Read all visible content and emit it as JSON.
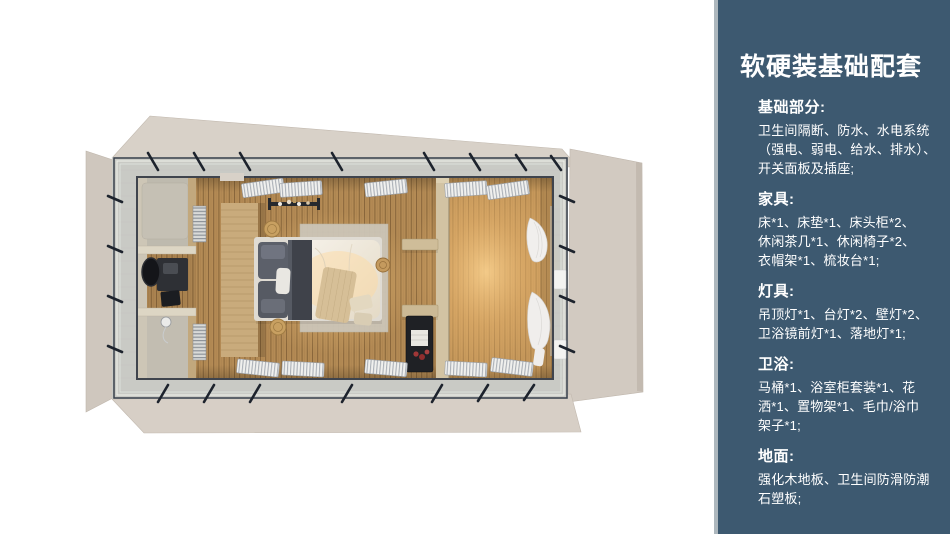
{
  "sidebar": {
    "title": "软硬装基础配套",
    "sections": [
      {
        "heading": "基础部分:",
        "lines": [
          "卫生间隔断、防水、水电系统",
          "（强电、弱电、给水、排水）、",
          "开关面板及插座;"
        ]
      },
      {
        "heading": "家具:",
        "lines": [
          "床*1、床垫*1、床头柜*2、",
          "休闲茶几*1、休闲椅子*2、",
          "衣帽架*1、梳妆台*1;"
        ]
      },
      {
        "heading": "灯具:",
        "lines": [
          "吊顶灯*1、台灯*2、壁灯*2、",
          "卫浴镜前灯*1、落地灯*1;"
        ]
      },
      {
        "heading": "卫浴:",
        "lines": [
          "马桶*1、浴室柜套装*1、花",
          "洒*1、置物架*1、毛巾/浴巾",
          "架子*1;"
        ]
      },
      {
        "heading": "地面:",
        "lines": [
          "强化木地板、卫生间防滑防潮",
          "石塑板;"
        ]
      }
    ],
    "colors": {
      "background": "#3d5970",
      "edge": "#adb7bd",
      "text": "#ffffff"
    }
  },
  "floorplan": {
    "description": "top-down 3d render of a container guest room with fold-out roof flaps, wrap-around deck with cable railing, bathroom zone, double bed, wardrobe shelves and curtained window wall",
    "colors": {
      "page_background": "#ffffff",
      "roof_flap": "#d6cec5",
      "deck": "#c9cac5",
      "railing_dark": "#2a313d",
      "wood_floor": "#b98f58",
      "warm_glow": "#ffd794",
      "bathroom_wall": "#d8d1c0",
      "headboard_wood": "#c9ab7c",
      "fixture_dark": "#23262b",
      "bedding_white": "#f2ede5",
      "accent_red": "#9c3434"
    }
  }
}
